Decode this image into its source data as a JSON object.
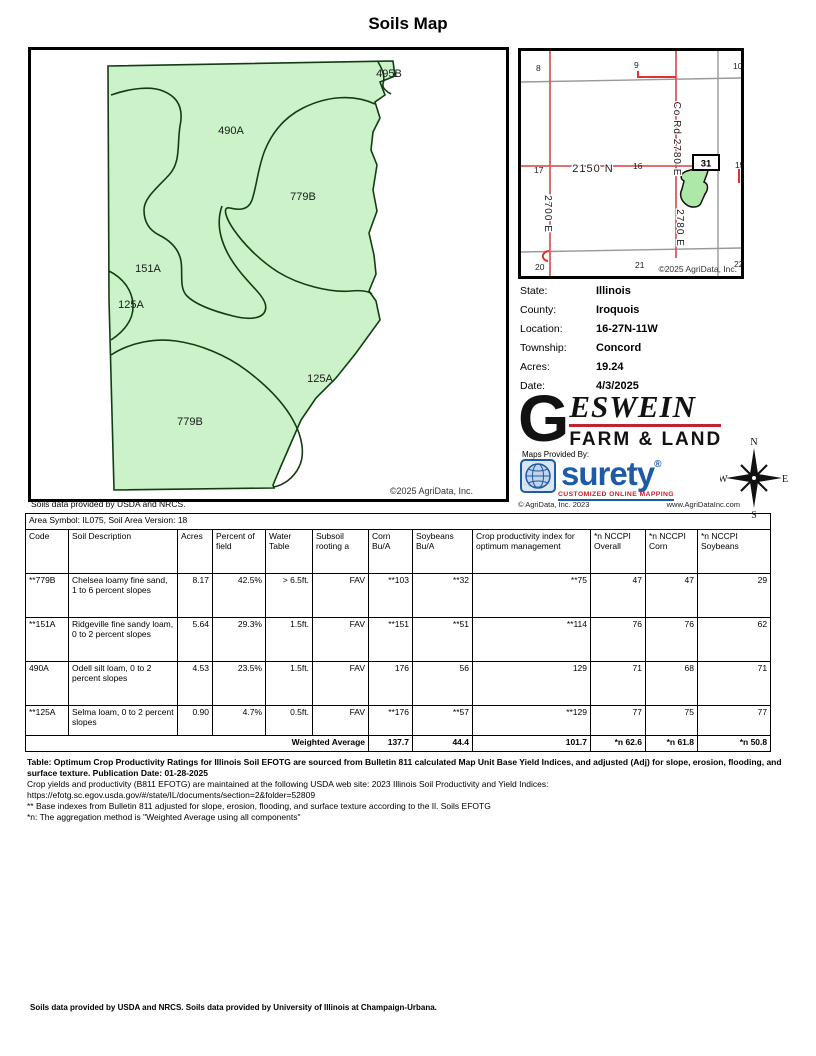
{
  "page": {
    "title": "Soils Map"
  },
  "colors": {
    "map_green": "#cbf2c8",
    "map_outline": "#123d12",
    "road_red": "#d85c5c",
    "tick_red": "#e03030",
    "surety_blue": "#1f5aa5",
    "logo_red": "#c32032"
  },
  "soil_map": {
    "caption": "Soils data provided by USDA and NRCS.",
    "copyright": "©2025 AgriData, Inc.",
    "labels": [
      {
        "text": "495B",
        "x": 358,
        "y": 27
      },
      {
        "text": "490A",
        "x": 200,
        "y": 84
      },
      {
        "text": "779B",
        "x": 272,
        "y": 150
      },
      {
        "text": "151A",
        "x": 117,
        "y": 222
      },
      {
        "text": "125A",
        "x": 100,
        "y": 258
      },
      {
        "text": "125A",
        "x": 289,
        "y": 332
      },
      {
        "text": "779B",
        "x": 159,
        "y": 375
      }
    ]
  },
  "locator": {
    "section_numbers": [
      {
        "text": "8",
        "x": 15,
        "y": 20
      },
      {
        "text": "9",
        "x": 113,
        "y": 17
      },
      {
        "text": "10",
        "x": 212,
        "y": 18
      },
      {
        "text": "17",
        "x": 13,
        "y": 122
      },
      {
        "text": "16",
        "x": 112,
        "y": 118
      },
      {
        "text": "15",
        "x": 214,
        "y": 117
      },
      {
        "text": "20",
        "x": 14,
        "y": 219
      },
      {
        "text": "21",
        "x": 114,
        "y": 217
      },
      {
        "text": "22",
        "x": 213,
        "y": 216
      }
    ],
    "road_labels": [
      {
        "text": "2150 N",
        "x": 72,
        "y": 118,
        "rot": 0,
        "size": 11
      },
      {
        "text": "Co Rd 2780 E",
        "x": 156,
        "y": 88,
        "rot": 90,
        "size": 10
      },
      {
        "text": "2780 E",
        "x": 159,
        "y": 177,
        "rot": 90,
        "size": 10
      },
      {
        "text": "2700 E",
        "x": 27,
        "y": 163,
        "rot": 90,
        "size": 10
      }
    ],
    "parcel_number": "31",
    "copyright": "©2025 AgriData, Inc."
  },
  "info": {
    "rows": [
      {
        "label": "State:",
        "value": "Illinois"
      },
      {
        "label": "County:",
        "value": "Iroquois"
      },
      {
        "label": "Location:",
        "value": "16-27N-11W"
      },
      {
        "label": "Township:",
        "value": "Concord"
      },
      {
        "label": "Acres:",
        "value": "19.24"
      },
      {
        "label": "Date:",
        "value": "4/3/2025"
      }
    ]
  },
  "branding": {
    "geswein": {
      "initial": "G",
      "name": "ESWEIN",
      "tagline": "FARM & LAND"
    },
    "maps_provided_by": "Maps Provided By:",
    "surety": {
      "name": "surety",
      "reg": "®",
      "tagline": "CUSTOMIZED ONLINE MAPPING",
      "copyright": "© AgriData, Inc. 2023",
      "url": "www.AgriDataInc.com"
    },
    "compass": {
      "n": "N",
      "e": "E",
      "s": "S",
      "w": "W"
    }
  },
  "table": {
    "area_line": "Area Symbol: IL075, Soil Area Version: 18",
    "columns": [
      "Code",
      "Soil Description",
      "Acres",
      "Percent of field",
      "Water Table",
      "Subsoil rooting a",
      "Corn Bu/A",
      "Soybeans Bu/A",
      "Crop productivity index for optimum management",
      "*n NCCPI Overall",
      "*n NCCPI Corn",
      "*n NCCPI Soybeans"
    ],
    "rows": [
      [
        "**779B",
        "Chelsea loamy fine sand, 1 to 6 percent slopes",
        "8.17",
        "42.5%",
        "> 6.5ft.",
        "FAV",
        "**103",
        "**32",
        "**75",
        "47",
        "47",
        "29"
      ],
      [
        "**151A",
        "Ridgeville fine sandy loam, 0 to 2 percent slopes",
        "5.64",
        "29.3%",
        "1.5ft.",
        "FAV",
        "**151",
        "**51",
        "**114",
        "76",
        "76",
        "62"
      ],
      [
        "490A",
        "Odell silt loam, 0 to 2 percent slopes",
        "4.53",
        "23.5%",
        "1.5ft.",
        "FAV",
        "176",
        "56",
        "129",
        "71",
        "68",
        "71"
      ],
      [
        "**125A",
        "Selma loam, 0 to 2 percent slopes",
        "0.90",
        "4.7%",
        "0.5ft.",
        "FAV",
        "**176",
        "**57",
        "**129",
        "77",
        "75",
        "77"
      ]
    ],
    "weighted": {
      "label": "Weighted Average",
      "values": [
        "137.7",
        "44.4",
        "101.7",
        "*n 62.6",
        "*n 61.8",
        "*n 50.8"
      ]
    }
  },
  "footnotes": [
    {
      "text": "Table: Optimum Crop Productivity Ratings for Illinois Soil EFOTG are sourced from Bulletin 811 calculated Map Unit Base Yield Indices, and adjusted (Adj) for slope, erosion, flooding, and surface texture. Publication Date: 01-28-2025",
      "bold": true,
      "link": false
    },
    {
      "text": "Crop yields and productivity (B811 EFOTG) are maintained at the following USDA web site: 2023 Illinois Soil Productivity and Yield Indices:",
      "bold": false,
      "link": false
    },
    {
      "text": "https://efotg.sc.egov.usda.gov/#/state/IL/documents/section=2&folder=52809",
      "bold": false,
      "link": true
    },
    {
      "text": "** Base indexes from Bulletin 811 adjusted for slope, erosion, flooding, and surface texture according to the Il. Soils EFOTG",
      "bold": false,
      "link": false
    },
    {
      "text": "*n: The aggregation method is \"Weighted Average using all components\"",
      "bold": false,
      "link": false
    }
  ],
  "footer": "Soils data provided by USDA and NRCS. Soils data provided by University of Illinois at Champaign-Urbana."
}
